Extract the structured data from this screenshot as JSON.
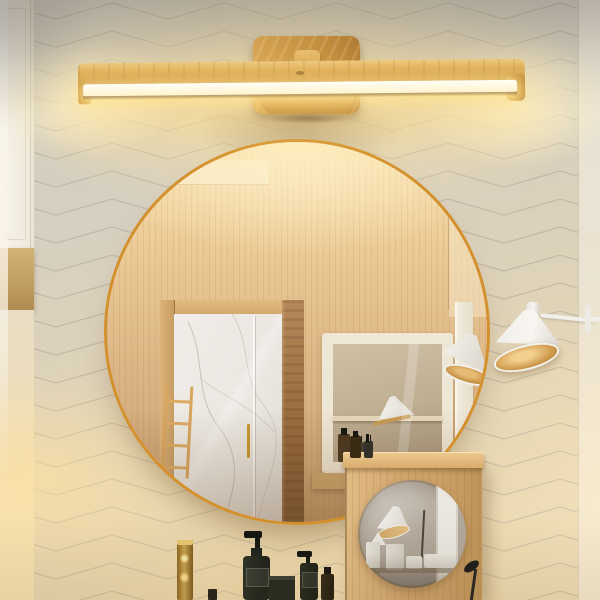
{
  "meta": {
    "type": "photograph",
    "description": "Product lifestyle photo of a wooden LED vanity bar light mounted on a chevron-tiled bathroom wall above a round gold-framed mirror, with a white cone wall lamp, an oak side panel with a small round mirror, a brass faucet and dark green toiletry bottles."
  },
  "scene": {
    "wall": {
      "pattern": "chevron-tile",
      "base_color": "#d6d0c4",
      "seam_color": "#b7ae9d",
      "warm_glow_color": "#f2dca8"
    },
    "vanity_light": {
      "name": "wooden-led-bar-sconce",
      "wood_color": "#d2a04c",
      "led_strip_color": "#fffbe8",
      "backplate": "rounded wooden square with small knob",
      "state": "on"
    },
    "round_mirror": {
      "name": "large-round-mirror",
      "frame_color": "#d3902c",
      "reflection": {
        "wood_wall_color": "#dcb080",
        "marble_color": "#eeebe5",
        "marble_vein_color": "#b4aea3",
        "ladder_color": "#d8a55d",
        "dark_door_panel_color": "#96683c",
        "cabinet_frame_color": "#efe7d5",
        "cabinet_glass_color": "#bfae92",
        "reflected_lamp_color": "#f2f0ea"
      }
    },
    "wall_lamp": {
      "name": "white-cone-wall-lamp",
      "shade_color": "#f3f1ec",
      "inner_glow_color": "#cf9a4e",
      "arm_color": "#f1efe9"
    },
    "side_panel": {
      "name": "oak-panel-with-round-mirror",
      "wood_color": "#d3a86f",
      "rail_color": "#e0b679",
      "small_mirror_reflection": {
        "base_color": "#b2a99c",
        "lamp_color": "#efede8",
        "jars_color": "#e8e5de"
      }
    },
    "accessories": {
      "faucet_color": "#caa34e",
      "bottles": [
        {
          "name": "pump-bottle-large",
          "color": "#232820"
        },
        {
          "name": "soap-box",
          "color": "#23261e"
        },
        {
          "name": "pump-bottle-medium",
          "color": "#20251b"
        },
        {
          "name": "bottle-small",
          "color": "#2c2417"
        },
        {
          "name": "rail-bottle-amber",
          "color": "#3a2c14"
        },
        {
          "name": "rail-bottle-pump",
          "color": "#34302a"
        }
      ],
      "black_fixture_color": "#1c1b19"
    },
    "left_door": {
      "panel_color": "#f5f1e8",
      "sill_color": "#c6a468"
    },
    "right_wall_band_color": "#ece3d0"
  },
  "palette": {
    "accent_gold": "#d3902c",
    "wood_light": "#eecb82",
    "wood_mid": "#c89242",
    "led_glow": "#ffe79a",
    "wall_grey": "#d5cfc2",
    "shadow": "#6e5532"
  }
}
